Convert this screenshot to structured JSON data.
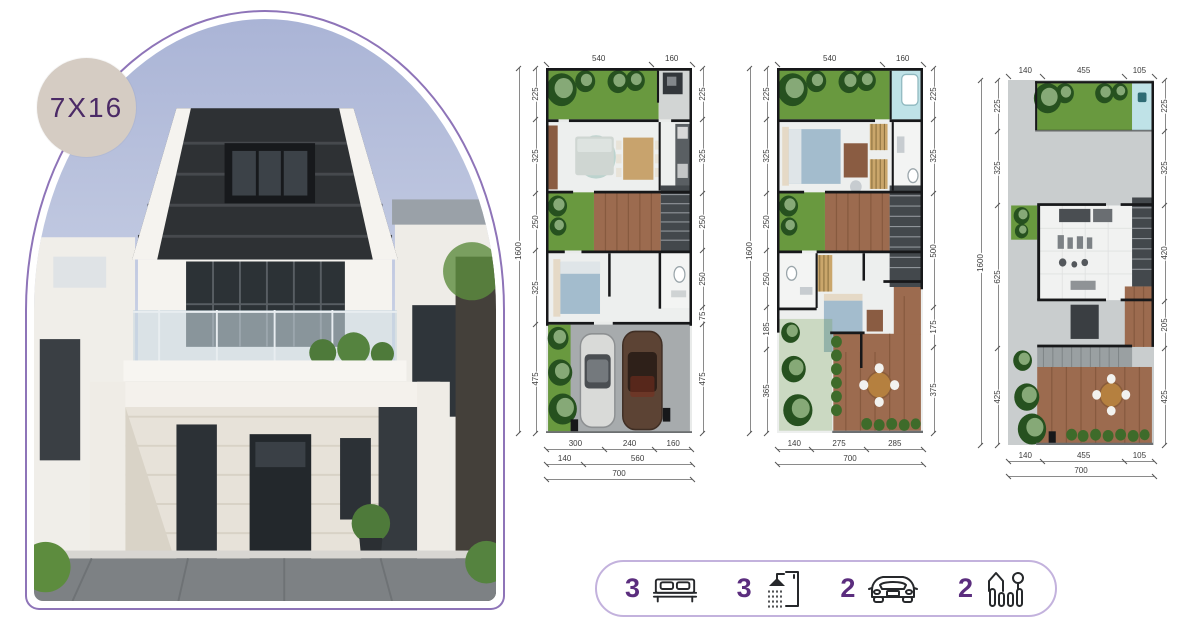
{
  "badge": {
    "label": "7X16"
  },
  "photo": {
    "description": "two-storey modern house with dark hip roof, glass balcony and carport"
  },
  "plans": [
    {
      "name": "floor-plan-ground",
      "overall_left": "1600",
      "top_dims": [
        "540",
        "160"
      ],
      "left_dims": [
        "225",
        "325",
        "250",
        "325",
        "475"
      ],
      "right_dims": [
        "225",
        "325",
        "250",
        "250",
        "75",
        "475"
      ],
      "bottom_rows": [
        [
          "300",
          "240",
          "160"
        ],
        [
          "140",
          "560"
        ],
        [
          "700"
        ]
      ]
    },
    {
      "name": "floor-plan-second",
      "overall_left": "1600",
      "top_dims": [
        "540",
        "160"
      ],
      "left_dims": [
        "225",
        "325",
        "250",
        "250",
        "185",
        "365"
      ],
      "right_dims": [
        "225",
        "325",
        "500",
        "175",
        "375"
      ],
      "bottom_rows": [
        [
          "140",
          "275",
          "285"
        ],
        [
          "700"
        ]
      ]
    },
    {
      "name": "floor-plan-roof",
      "overall_left": "1600",
      "top_dims": [
        "140",
        "455",
        "105"
      ],
      "left_dims": [
        "225",
        "325",
        "625",
        "425"
      ],
      "right_dims": [
        "225",
        "325",
        "420",
        "205",
        "425"
      ],
      "bottom_rows": [
        [
          "140",
          "455",
          "105"
        ],
        [
          "700"
        ]
      ]
    }
  ],
  "features": [
    {
      "count": "3",
      "icon": "bed-icon"
    },
    {
      "count": "3",
      "icon": "shower-icon"
    },
    {
      "count": "2",
      "icon": "car-icon"
    },
    {
      "count": "2",
      "icon": "garden-icon"
    }
  ],
  "colors": {
    "accent_purple": "#5b2d7e",
    "arch_border": "#8e74b8",
    "pill_border": "#c3b2dd",
    "badge_bg": "#d5ccc3",
    "badge_text": "#4b2a66",
    "grass": "#69993f",
    "wood_deck": "#9c6b4f",
    "pool": "#bfe2e7"
  }
}
